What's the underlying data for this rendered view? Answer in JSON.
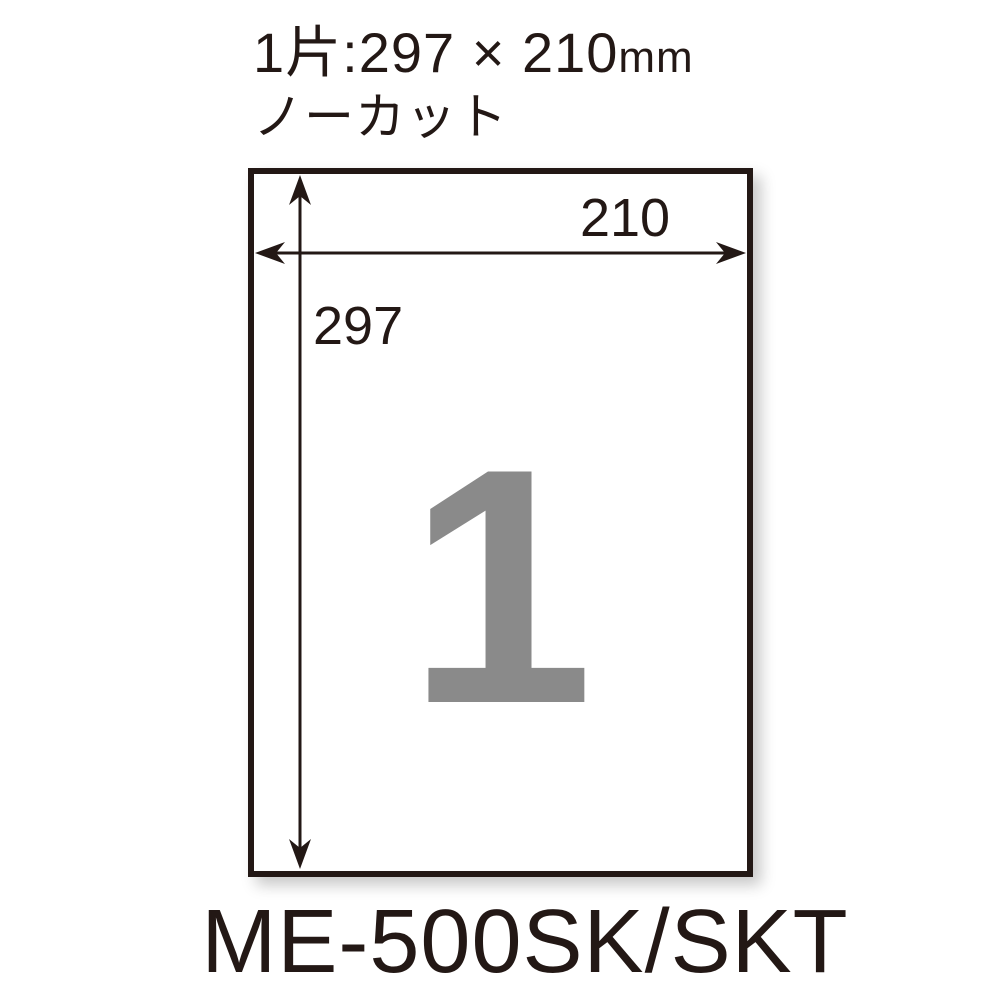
{
  "header": {
    "piece_size_prefix": "1片:297 × 210",
    "piece_size_unit": "mm",
    "cut_type": "ノーカット"
  },
  "diagram": {
    "width_label": "210",
    "height_label": "297",
    "piece_count": "1"
  },
  "footer": {
    "model_number": "ME-500SK/SKT"
  },
  "colors": {
    "ink": "#231815",
    "count_gray": "#8a8a8a",
    "background": "#ffffff"
  }
}
